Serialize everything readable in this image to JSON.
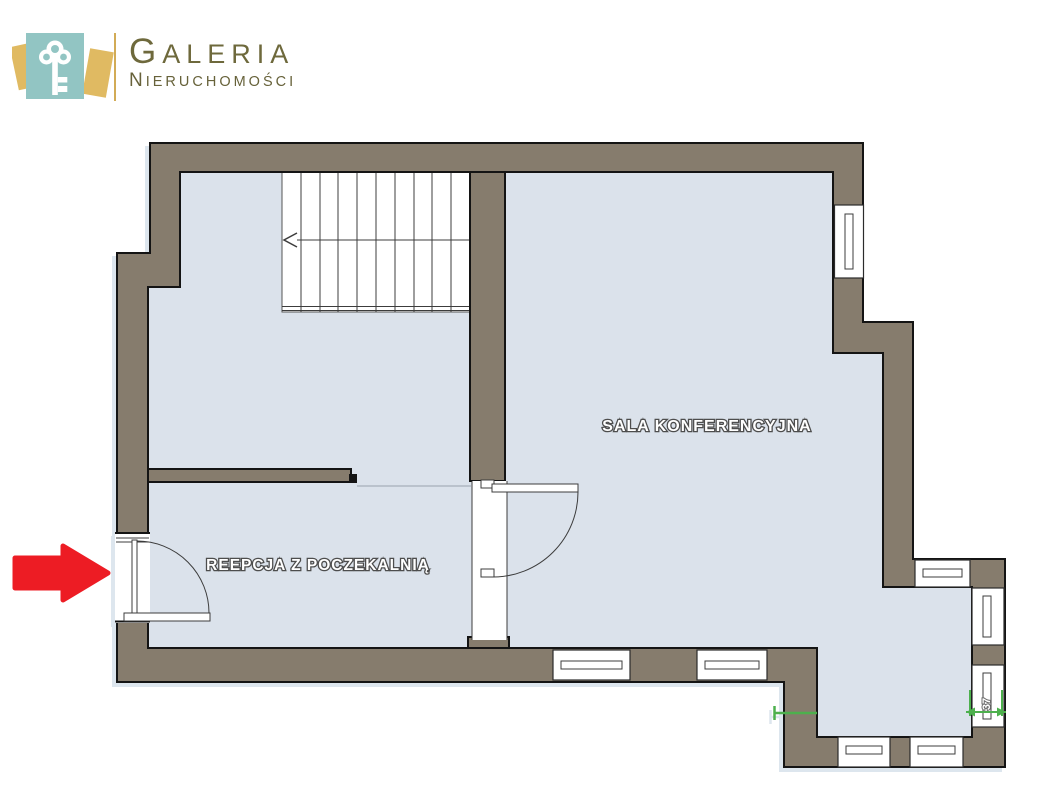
{
  "logo": {
    "title": "GALERIA",
    "subtitle": "NIERUCHOMOŚCI"
  },
  "plan": {
    "rooms": [
      {
        "id": "conference-room",
        "label": "SALA KONFERENCYJNA"
      },
      {
        "id": "reception",
        "label": "REEPCJA Z POCZEKALNIĄ"
      }
    ],
    "dimensions": [
      {
        "label": "37"
      }
    ]
  },
  "colors": {
    "wall": "#867C6D",
    "floor": "#DBE2EB",
    "outline": "#141414",
    "stair_white": "#FFFFFF",
    "arrow_red": "#ED1C24",
    "dimension_green": "#4DB04D",
    "logo_teal": "#92C5C3",
    "logo_gold": "#E0BA62",
    "logo_divider_gold": "#D2AB56",
    "logo_text_olive": "#6E693C"
  },
  "icons": [
    {
      "name": "key-icon"
    },
    {
      "name": "entrance-arrow-icon"
    }
  ]
}
